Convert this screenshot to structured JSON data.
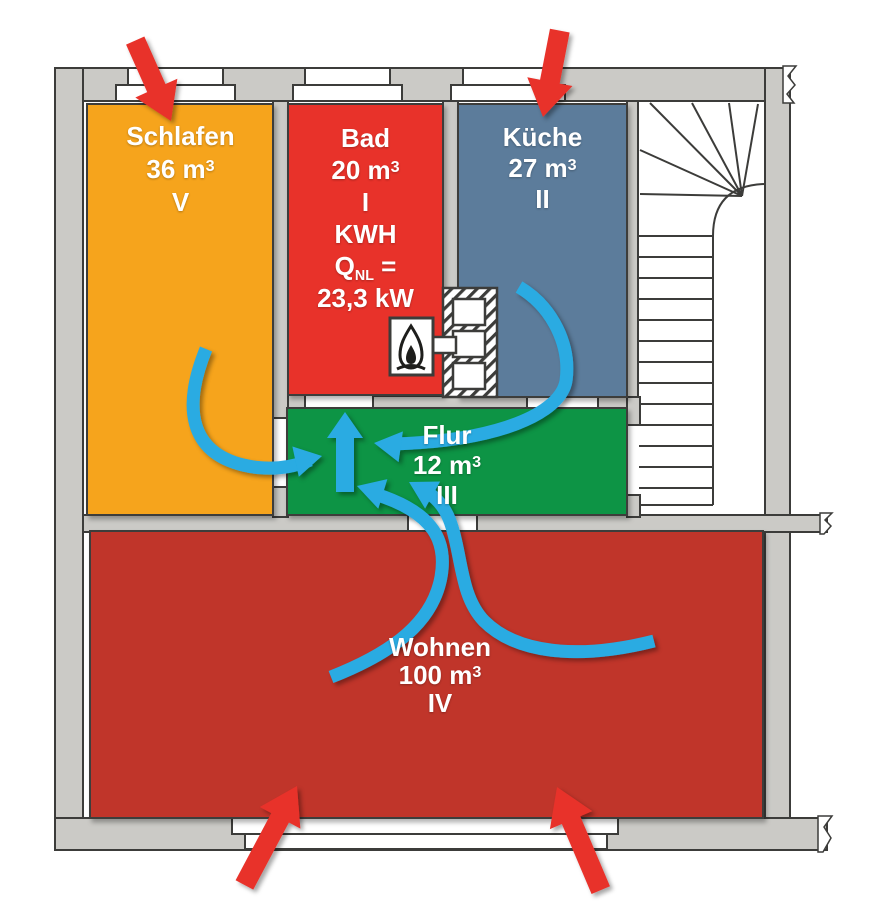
{
  "diagram_type": "apartment-floor-plan-with-combustion-air-flow",
  "rooms": {
    "schlafen": {
      "name": "Schlafen",
      "volume": "36 m",
      "volume_sup": "3",
      "numeral": "V",
      "fill": "#f6a41f"
    },
    "bad": {
      "name": "Bad",
      "volume": "20 m",
      "volume_sup": "3",
      "numeral": "I",
      "heater_label": "KWH",
      "q_symbol": "Q",
      "q_sub": "NL",
      "q_eq": "=",
      "q_value": "23,3 kW",
      "fill": "#e8322b"
    },
    "kueche": {
      "name": "Küche",
      "volume": "27 m",
      "volume_sup": "3",
      "numeral": "II",
      "fill": "#5c7b9b"
    },
    "flur": {
      "name": "Flur",
      "volume": "12 m",
      "volume_sup": "3",
      "numeral": "III",
      "fill": "#0b9444"
    },
    "wohnen": {
      "name": "Wohnen",
      "volume": "100 m",
      "volume_sup": "3",
      "numeral": "IV",
      "fill": "#c0342a"
    }
  },
  "arrows": {
    "outdoor_air_color": "#e8312a",
    "indoor_flow_color": "#29abe2",
    "outdoor_air": [
      "into-schlafen-window",
      "into-kueche-window",
      "into-wohnen-window-left",
      "into-wohnen-window-right"
    ],
    "indoor_flow": [
      "schlafen-to-flur",
      "kueche-to-flur",
      "flur-to-bad-heater",
      "wohnen-to-flur-left",
      "wohnen-to-flur-right"
    ]
  },
  "icons": {
    "heater": "gas-flame-icon",
    "chimney": "chimney-flue-hatched",
    "stairs": "winder-staircase"
  },
  "palette": {
    "wall_gray": "#cbcac6",
    "outline": "#3c3c3a",
    "background": "#ffffff"
  }
}
